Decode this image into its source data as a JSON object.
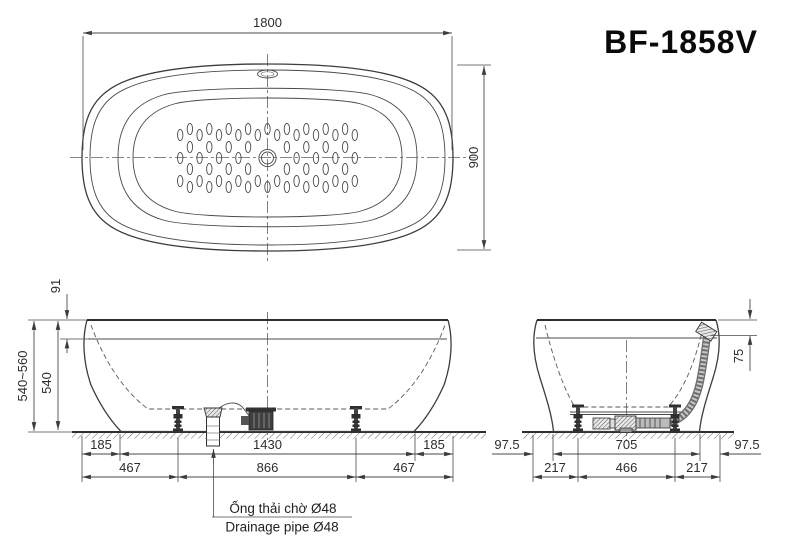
{
  "title": "BF-1858V",
  "views": {
    "top": {
      "dim_length": "1800",
      "dim_width": "900"
    },
    "front": {
      "dim_rim_offset": "91",
      "dim_height_range": "540~560",
      "dim_height": "540",
      "dims_row1": [
        "185",
        "1430",
        "185"
      ],
      "dims_row2": [
        "467",
        "866",
        "467"
      ]
    },
    "side": {
      "dim_overflow_offset": "75",
      "dims_row1": [
        "97.5",
        "705",
        "97.5"
      ],
      "dims_row2": [
        "217",
        "466",
        "217"
      ]
    }
  },
  "annotation": {
    "vi": "Ống thải chờ Ø48",
    "en": "Drainage pipe Ø48"
  },
  "colors": {
    "line": "#3c3c3c",
    "text": "#2d2d2d",
    "hatch": "#6a6a6a"
  }
}
